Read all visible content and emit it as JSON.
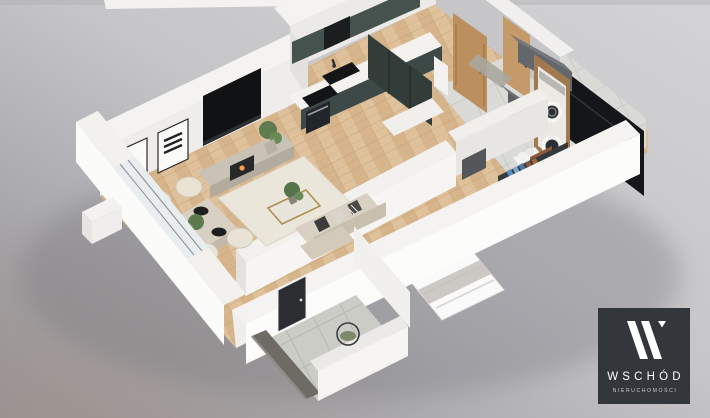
{
  "scene": {
    "type": "isometric-3d-floorplan-render",
    "rooms": [
      "living-room",
      "dining-area",
      "kitchen",
      "entrance-hall",
      "bathroom",
      "bedroom",
      "balcony"
    ],
    "palette": {
      "background_top": "#d2d2d4",
      "background_bottom": "#96959a",
      "warm_corner": "#a79a92",
      "wall_white": "#f7f6f4",
      "wall_light": "#eceae7",
      "wall_shadow": "#c7c7c9",
      "floor_wood": "#dfc19b",
      "floor_wood_dark": "#c9a87d",
      "bath_tile": "#d8d8d5",
      "kitchen_teal": "#3d4946",
      "kitchen_teal_dark": "#2e3835",
      "countertop": "#f4f2ee",
      "appliance_black": "#17181a",
      "wood_door": "#bb8f5e",
      "sofa_beige": "#d3cabb",
      "rug_cream": "#ebe6da",
      "bed_white": "#fbfafa",
      "shelf_dark": "#37393c",
      "towel_blue": "#5c8fc0",
      "towel_red": "#a53d3a",
      "towel_brown": "#8a5a3b",
      "plant_green": "#5d7a4e",
      "table_gold": "#b09052",
      "balcony_tile": "#c9c8c4",
      "balustrade_gray": "#6e6b65"
    }
  },
  "watermark": {
    "brand": "WSCHÓD",
    "tagline": "NIERUCHOMOŚCI",
    "icon": "wschod-w-logo-mark",
    "panel_color": "#33363a",
    "brand_color": "#ffffff",
    "tagline_color": "#c9cacd"
  }
}
